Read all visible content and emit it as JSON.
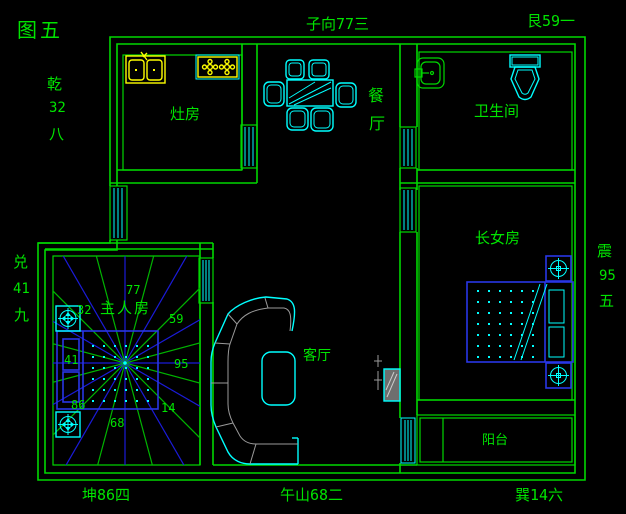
{
  "title": "图五",
  "compass_labels": {
    "n": "子向77三",
    "ne": "艮59一",
    "nw_name": "乾",
    "nw_num": "32",
    "nw_rank": "八",
    "w_name": "兑",
    "w_num": "41",
    "w_rank": "九",
    "e_name": "震",
    "e_num": "95",
    "e_rank": "五",
    "sw": "坤86四",
    "s": "午山68二",
    "se": "巽14六"
  },
  "rooms": {
    "kitchen": "灶房",
    "dining_char1": "餐",
    "dining_char2": "厅",
    "bathroom": "卫生间",
    "eldest_daughter": "长女房",
    "master": "主人房",
    "living": "客厅",
    "balcony": "阳台"
  },
  "star_numbers": {
    "n": "77",
    "nw": "32",
    "ne": "59",
    "w": "41",
    "e": "95",
    "sw": "86",
    "se": "14",
    "s": "68"
  },
  "colors": {
    "background": "#000000",
    "wall": "#00d800",
    "text": "#00e400",
    "furniture_cyan": "#00ffff",
    "fixture_yellow": "#ffff00",
    "bed_blue": "#2936e6",
    "ray_blue": "#1b1bd8",
    "ray_green": "#00b400",
    "sofa_gray": "#9a9a9a",
    "tv_screen": "#6e6e6e"
  }
}
